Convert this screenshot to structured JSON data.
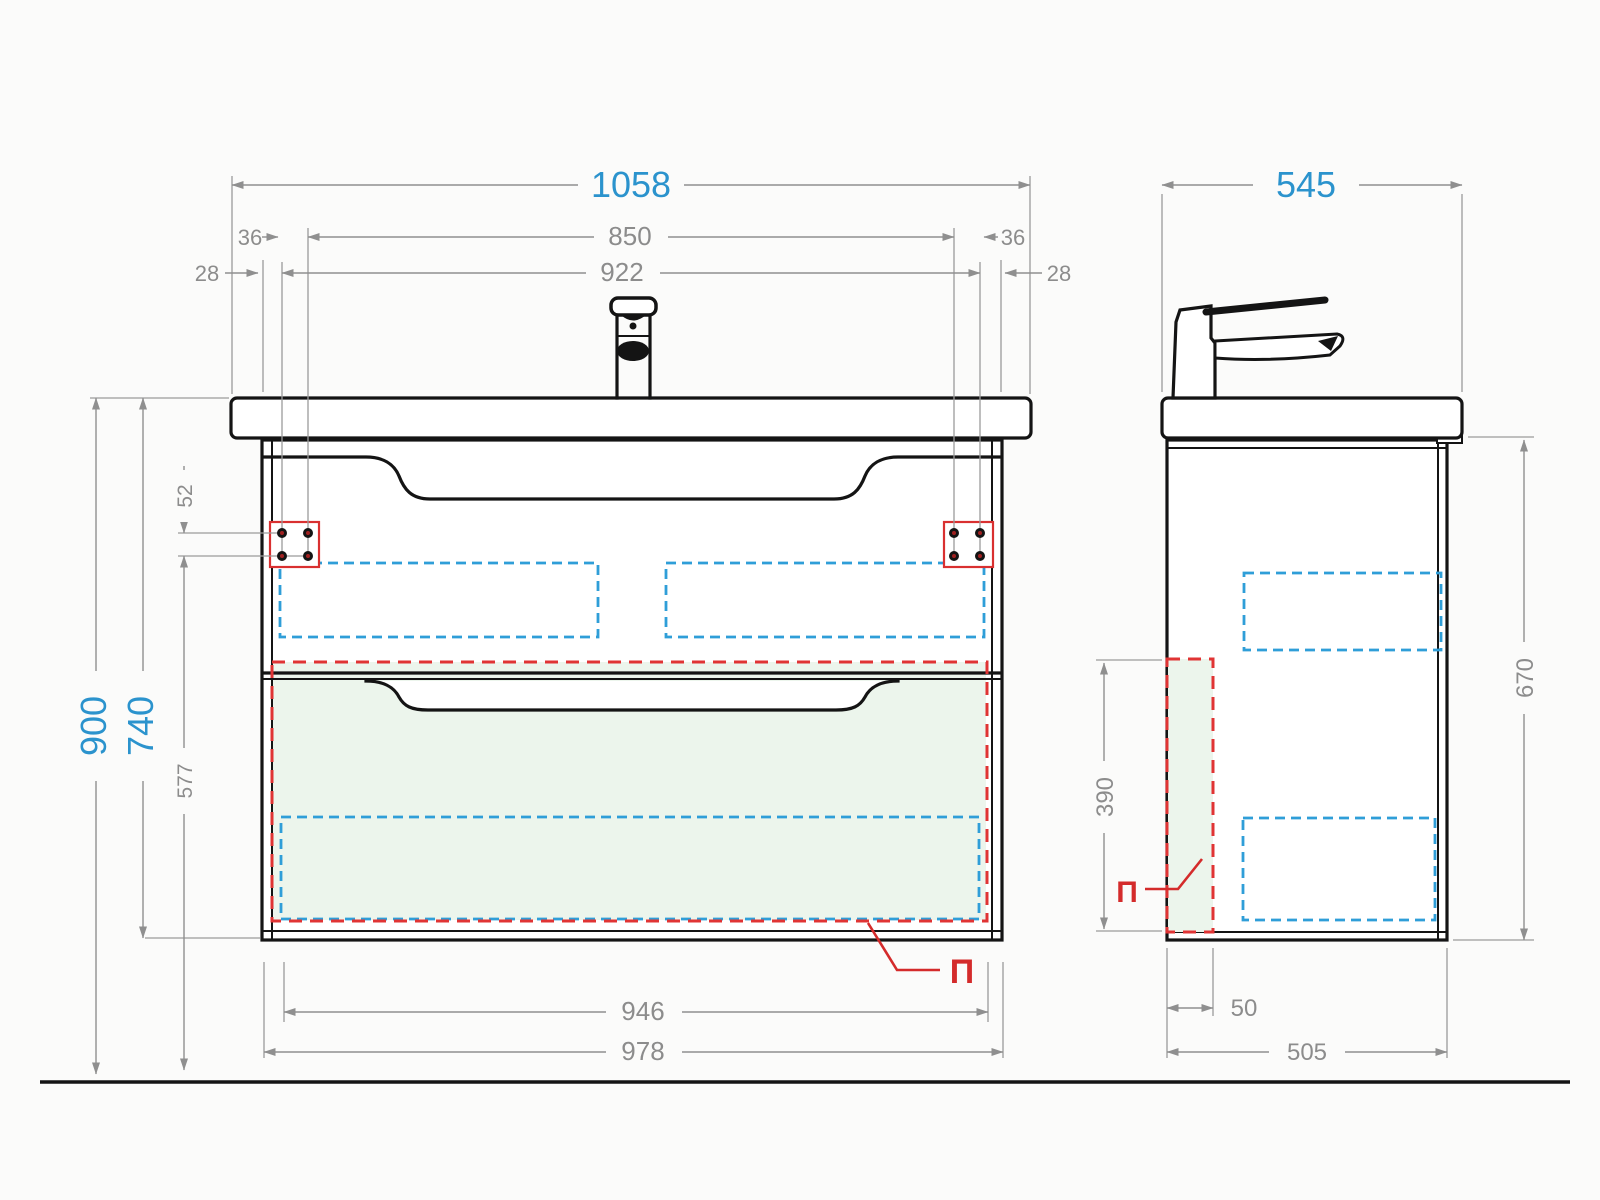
{
  "drawing": {
    "type": "technical-drawing",
    "subject": "wall-hung washbasin vanity cabinet, front and side projections with mounting dimensions"
  },
  "front_view": {
    "dim_countertop_width": "1058",
    "dim_mount_span_inner": "850",
    "dim_mount_span_outer": "922",
    "dim_edge_offset_left": "36",
    "dim_edge_offset_right": "36",
    "dim_side_offset_left": "28",
    "dim_side_offset_right": "28",
    "dim_total_height": "900",
    "dim_cabinet_height": "740",
    "dim_hole_spacing": "52",
    "dim_hole_to_bottom": "577",
    "dim_drawer_box_width": "946",
    "dim_cabinet_width": "978",
    "panel_label": "П"
  },
  "side_view": {
    "dim_depth": "545",
    "dim_cabinet_height": "670",
    "dim_panel_height": "390",
    "dim_panel_thickness": "50",
    "dim_cabinet_depth": "505",
    "panel_label": "П"
  },
  "colors": {
    "background": "#fbfbfa",
    "accent_blue_text": "#2b93cd",
    "dim_gray": "#8c8c8c",
    "outline_black": "#141414",
    "bracket_red": "#d93030",
    "dashed_red": "#e03434",
    "dashed_blue": "#2f9ed8",
    "fill_green": "#ecf5ec",
    "fill_gray": "#e9e9ec"
  }
}
